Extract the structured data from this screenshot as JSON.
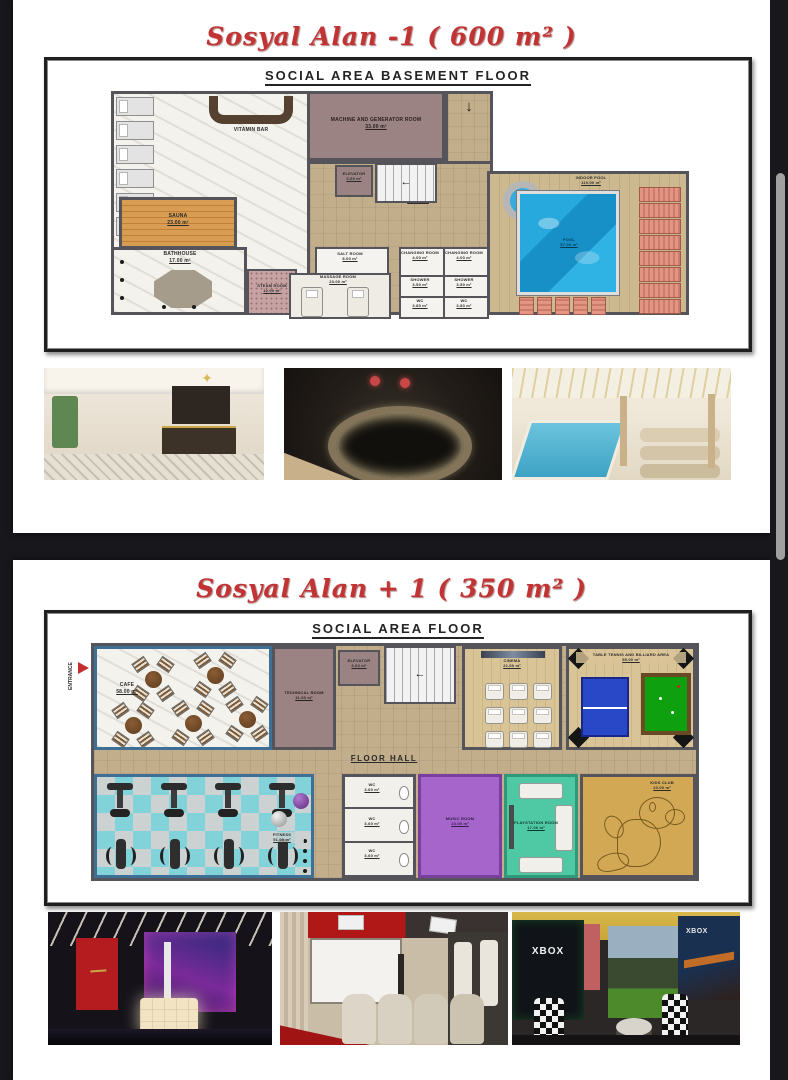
{
  "page1": {
    "title": "Sosyal Alan -1 ( 600 m² )",
    "plan_title": "SOCIAL AREA BASEMENT FLOOR",
    "rooms": {
      "lounge": {
        "name": "LOUNGE",
        "area": "43.00 m²"
      },
      "vitamin_bar": {
        "name": "VITAMIN BAR"
      },
      "machine_room": {
        "name": "MACHINE AND GENERATOR ROOM",
        "area": "33.00 m²"
      },
      "elevator": {
        "name": "ELEVATOR",
        "area": "3.60 m²"
      },
      "wetted_area": {
        "name": "WETTED AREA",
        "area": "59.00 m²"
      },
      "sauna": {
        "name": "SAUNA",
        "area": "23.00 m²"
      },
      "bathhouse": {
        "name": "BATHHOUSE",
        "area": "17.00 m²"
      },
      "steam_room": {
        "name": "STEAM ROOM",
        "area": "12.00 m²"
      },
      "salt_room": {
        "name": "SALT ROOM",
        "area": "8.00 m²"
      },
      "massage_room": {
        "name": "MASSAGE ROOM",
        "area": "23.00 m²"
      },
      "changing_room_1": {
        "name": "CHANGING ROOM",
        "area": "4.00 m²"
      },
      "changing_room_2": {
        "name": "CHANGING ROOM",
        "area": "4.00 m²"
      },
      "shower_1": {
        "name": "SHOWER",
        "area": "3.50 m²"
      },
      "shower_2": {
        "name": "SHOWER",
        "area": "3.50 m²"
      },
      "wc_1": {
        "name": "WC",
        "area": "3.80 m²"
      },
      "wc_2": {
        "name": "WC",
        "area": "3.80 m²"
      },
      "indoor_pool": {
        "name": "INDOOR POOL",
        "area": "110.00 m²"
      },
      "pool": {
        "name": "POOL",
        "area": "57.00 m²"
      }
    },
    "photos": {
      "photo1": "spa reception interior render",
      "photo2": "round jacuzzi dark mosaic render",
      "photo3": "indoor pool hall with loungers render"
    }
  },
  "page2": {
    "title": "Sosyal Alan + 1 ( 350 m² )",
    "plan_title": "SOCIAL AREA FLOOR",
    "rooms": {
      "entrance": {
        "name": "ENTRANCE"
      },
      "cafe": {
        "name": "CAFE",
        "area": "58.00 m²"
      },
      "technical_room": {
        "name": "TECHNICAL ROOM",
        "area": "11.00 m²"
      },
      "elevator": {
        "name": "ELEVATOR",
        "area": "3.60 m²"
      },
      "cinema": {
        "name": "CINEMA",
        "area": "21.00 m²"
      },
      "games_area": {
        "name": "TABLE TENNIS AND BILLIARD AREA",
        "area": "55.00 m²"
      },
      "floor_hall": {
        "name": "FLOOR HALL"
      },
      "fitness": {
        "name": "FITNESS",
        "area": "51.00 m²"
      },
      "wc_1": {
        "name": "WC",
        "area": "3.60 m²"
      },
      "wc_2": {
        "name": "WC",
        "area": "3.60 m²"
      },
      "wc_3": {
        "name": "WC",
        "area": "3.60 m²"
      },
      "music_room": {
        "name": "MUSIC ROOM",
        "area": "23.00 m²"
      },
      "playstation_room": {
        "name": "PLAYSTATION ROOM",
        "area": "17.00 m²"
      },
      "kids_club": {
        "name": "KIDS CLUB",
        "area": "23.00 m²"
      }
    },
    "photo_texts": {
      "xbox": "XBOX"
    },
    "photos": {
      "photo1": "night club interior render",
      "photo2": "home cinema interior render",
      "photo3": "xbox game room render"
    }
  },
  "colors": {
    "title_red": "#c23434",
    "pool_blue": "#1b9ed6",
    "music_purple": "#a565cb",
    "playstation_teal": "#4ec9a4",
    "fitness_cyan": "#82d2da",
    "kids_tan": "#d2a855",
    "background_dark": "#17171c"
  }
}
